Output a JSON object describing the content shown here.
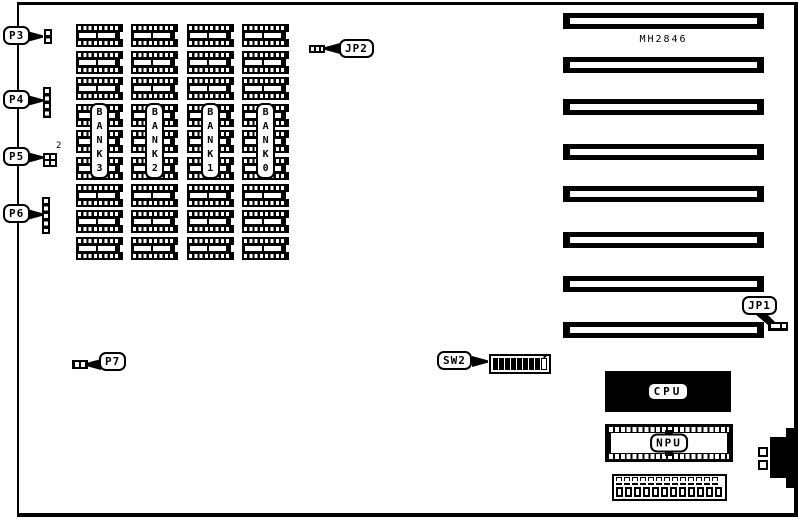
{
  "board": {
    "silkscreen_text": "MH2846",
    "ink_color": "#000000",
    "background_color": "#ffffff"
  },
  "connectors": {
    "p3": {
      "label": "P3"
    },
    "p4": {
      "label": "P4"
    },
    "p5": {
      "label": "P5",
      "pin_marker": "2"
    },
    "p6": {
      "label": "P6"
    },
    "p7": {
      "label": "P7"
    },
    "jp2": {
      "label": "JP2"
    },
    "jp1": {
      "label": "JP1"
    },
    "sw2": {
      "label": "SW2",
      "cells": [
        "filled",
        "filled",
        "filled",
        "filled",
        "filled",
        "filled",
        "filled",
        "filled",
        "open"
      ]
    }
  },
  "memory": {
    "chips_per_bank": 9,
    "banks": [
      {
        "id": "bank-3",
        "label": "B\nA\nN\nK\n3"
      },
      {
        "id": "bank-2",
        "label": "B\nA\nN\nK\n2"
      },
      {
        "id": "bank-1",
        "label": "B\nA\nN\nK\n1"
      },
      {
        "id": "bank-0",
        "label": "B\nA\nN\nK\n0"
      }
    ]
  },
  "sockets": {
    "cpu": {
      "label": "CPU"
    },
    "npu": {
      "label": "NPU"
    }
  },
  "expansion": {
    "slot_count": 8
  },
  "bottom_connector": {
    "top_pins": 13,
    "dashes": 13,
    "bottom_pins": 12
  }
}
